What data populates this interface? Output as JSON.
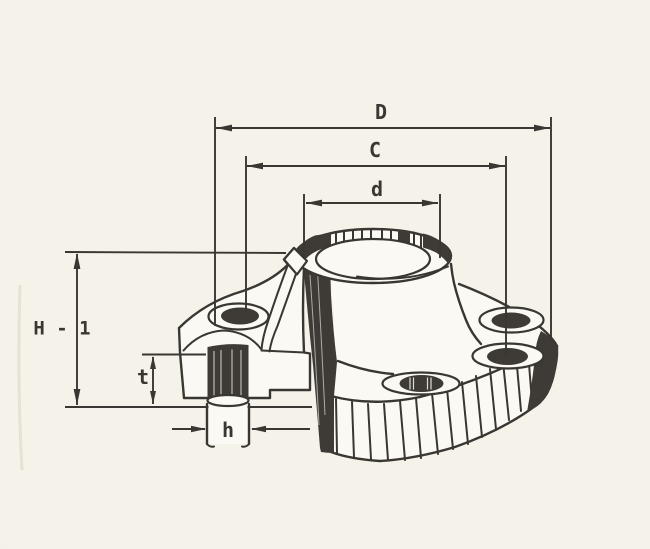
{
  "figure": {
    "type": "technical-drawing",
    "subject": "weld-neck flange isometric cutaway with dimension callouts"
  },
  "dimensions": {
    "outer_diameter": {
      "label": "D"
    },
    "bolt_circle_diameter": {
      "label": "C"
    },
    "hub_diameter": {
      "label": "d"
    },
    "overall_height": {
      "label": "H - 1"
    },
    "flange_thickness": {
      "label": "t"
    },
    "bolt_hole_diameter": {
      "label": "h"
    }
  },
  "colors": {
    "ink": "#3a3733",
    "ink-fill": "#3e3a35",
    "paper": "#f5f2ea",
    "lite": "#fbf9f3",
    "streak": "#d9d4c6"
  }
}
